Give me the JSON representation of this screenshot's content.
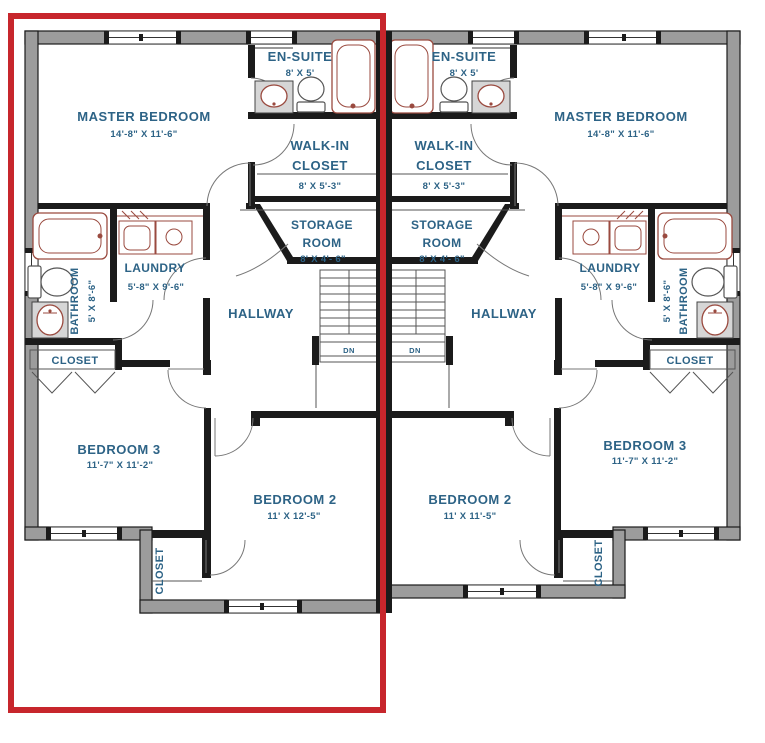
{
  "floorplan": {
    "title": "duplex-second-floor-plan",
    "colors": {
      "highlight_red": "#c7262c",
      "wall_gray": "#9c9c9c",
      "label_blue": "#2d6386",
      "fixture_red": "#9a4a3f"
    },
    "highlight": {
      "shape": "rectangle-outline",
      "around": "left unit",
      "color": "#c7262c"
    },
    "units": [
      {
        "side": "left",
        "highlighted": true,
        "master_bedroom": {
          "name": "MASTER BEDROOM",
          "dims": "14'-8\" X 11'-6\""
        },
        "en_suite": {
          "name": "EN-SUITE",
          "dims": "8' X 5'"
        },
        "walk_in_closet": {
          "line1": "WALK-IN",
          "line2": "CLOSET",
          "dims": "8' X 5'-3\""
        },
        "storage_room": {
          "line1": "STORAGE",
          "line2": "ROOM",
          "dims": "8' X 4'- 6\""
        },
        "laundry": {
          "name": "LAUNDRY",
          "dims": "5'-8\" X 9'-6\""
        },
        "bathroom": {
          "name": "BATHROOM",
          "dims": "5' X 8'-6\""
        },
        "hallway": {
          "name": "HALLWAY"
        },
        "closet": {
          "name": "CLOSET"
        },
        "bedroom3": {
          "name": "BEDROOM 3",
          "dims": "11'-7\" X 11'-2\""
        },
        "bedroom2": {
          "name": "BEDROOM 2",
          "dims": "11' X 12'-5\""
        },
        "bedroom2_closet": {
          "name": "CLOSET"
        },
        "stairs": {
          "label": "DN"
        }
      },
      {
        "side": "right",
        "highlighted": false,
        "master_bedroom": {
          "name": "MASTER BEDROOM",
          "dims": "14'-8\" X 11'-6\""
        },
        "en_suite": {
          "name": "EN-SUITE",
          "dims": "8' X 5'"
        },
        "walk_in_closet": {
          "line1": "WALK-IN",
          "line2": "CLOSET",
          "dims": "8' X 5'-3\""
        },
        "storage_room": {
          "line1": "STORAGE",
          "line2": "ROOM",
          "dims": "8' X 4'- 6\""
        },
        "laundry": {
          "name": "LAUNDRY",
          "dims": "5'-8\" X 9'-6\""
        },
        "bathroom": {
          "name": "BATHROOM",
          "dims": "5' X 8'-6\""
        },
        "hallway": {
          "name": "HALLWAY"
        },
        "closet": {
          "name": "CLOSET"
        },
        "bedroom2": {
          "name": "BEDROOM 2",
          "dims": "11' X 11'-5\""
        },
        "bedroom3": {
          "name": "BEDROOM 3",
          "dims": "11'-7\" X 11'-2\""
        },
        "bedroom2_closet": {
          "name": "CLOSET"
        },
        "stairs": {
          "label": "DN"
        }
      }
    ]
  }
}
